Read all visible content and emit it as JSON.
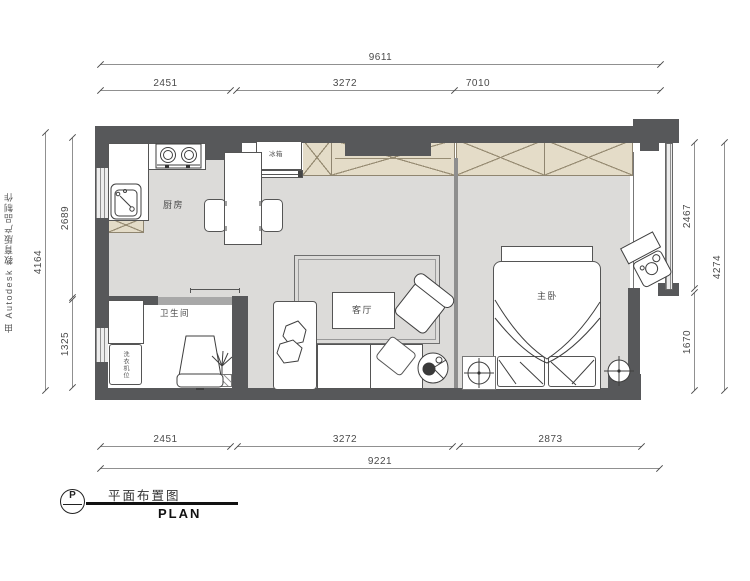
{
  "watermark": {
    "text": "由 Autodesk 教育版产品制作"
  },
  "title_block": {
    "marker": "P",
    "title": "平面布置图",
    "plan": "PLAN"
  },
  "rooms": {
    "kitchen": "厨房",
    "fridge": "冰箱",
    "bathroom": "卫生间",
    "washer": "洗衣机位",
    "living": "客厅",
    "bedroom": "主卧"
  },
  "dimensions": {
    "top": {
      "overall": "9611",
      "segments": [
        "2451",
        "3272",
        "7010"
      ]
    },
    "bottom": {
      "overall": "9221",
      "segments": [
        "2451",
        "3272",
        "2873"
      ]
    },
    "left": {
      "overall": "4164",
      "segments": [
        "2689",
        "1325"
      ]
    },
    "right": {
      "overall": "4274",
      "segments": [
        "2467",
        "1670"
      ]
    }
  },
  "colors": {
    "wall": "#57585A",
    "floor": "#DCDBD9",
    "cabinet": "#E4DCC8"
  }
}
